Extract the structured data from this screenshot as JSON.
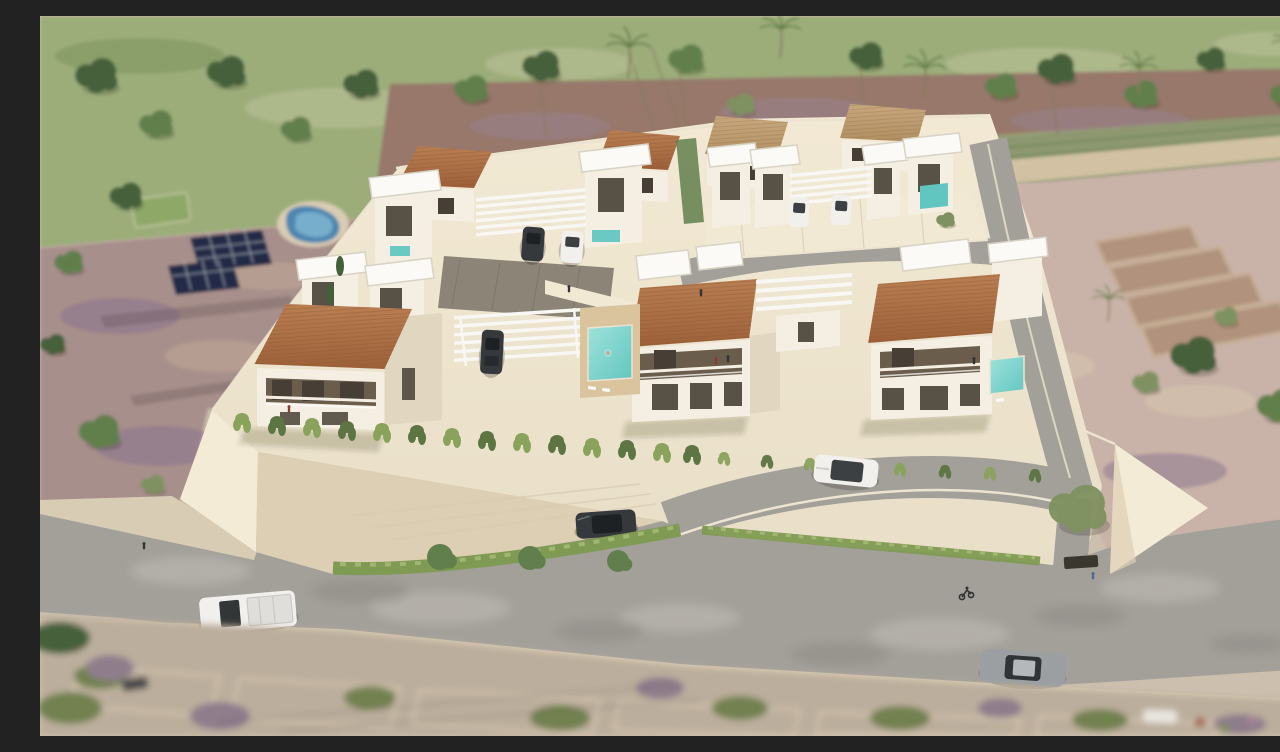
{
  "image": {
    "width": 1280,
    "height": 720,
    "alt": "Aerial 3D architectural rendering of a walled residential development: three terracotta-roofed white villas in front, rows of white cubic villas with flat slab roofs and pergola carports behind, a central turquoise pool with wooden deck, curved internal streets with parked and moving cars, a perimeter retaining wall draped with vines, a gray public road with a white pickup, gray sedan, cyclist and pedestrians, a neighboring plot with blue pool, solar panels and green court on the left, terraced pink farmland with stone walls on the right, a green tree-lined hillside above and a blurred old-town strip below."
  },
  "palette": {
    "grass_light": "#bcc199",
    "grass_mid": "#9cad7a",
    "grass_dark": "#7e9460",
    "scrub": "#8d986f",
    "tree_dark": "#44603a",
    "tree_mid": "#617f4c",
    "tree_olive": "#7f9160",
    "trunk": "#8a7a5e",
    "palm_frond": "#5f7c43",
    "mulch": "#97786a",
    "mulch_purple": "#9a8394",
    "path_sand": "#d2c1a3",
    "terrain_pink": "#c9b3a8",
    "terrain_sand": "#d9c8b0",
    "ruin_stone": "#c4aa8d",
    "ruin_fill": "#ab8b73",
    "plot_mauve": "#a78f8b",
    "plot_purple": "#8a7490",
    "plot_tan": "#c3a996",
    "court_green": "#8ea868",
    "pool_blue": "#4e86b0",
    "pool_blue_light": "#82b8d3",
    "solar_dark": "#232c47",
    "solar_grid": "#cdd3de",
    "platform": "#e9dfc8",
    "platform_light": "#f2e9d4",
    "paver_dark": "#8d8478",
    "wall_bright": "#f4ebd6",
    "wall_shade": "#ddcfb3",
    "house_white": "#f4efe2",
    "house_shade": "#e1d7c1",
    "window_dark": "#473f35",
    "recess": "#6b5d4c",
    "roof_terra": "#b97f52",
    "roof_terra_dark": "#9c6038",
    "roof_tan": "#c7a87e",
    "roof_tan_dark": "#b08f62",
    "tile_line": "#8c5633",
    "slab_white": "#fbfaf6",
    "slab_edge": "#d8d3c4",
    "pergola": "#f8f7f3",
    "road": "#a3a09a",
    "road_light": "#c7c3bb",
    "road_dark": "#8a8681",
    "curb": "#ece4d0",
    "sidewalk": "#d9ccb4",
    "hedge": "#7f9a52",
    "hedge_light": "#a9bd7a",
    "vine": "#8aa35c",
    "vine_dark": "#5c7542",
    "deck": "#d9c49e",
    "teal": "#62c6c0",
    "teal_light": "#9fe2db",
    "car_dark": "#35393c",
    "car_white": "#f1f0ec",
    "car_gray": "#9b9fa2",
    "glass": "#1d2124",
    "truck_bed": "#dfdedb",
    "person_dark": "#333333",
    "person_red": "#8a3b30",
    "person_blue": "#4a6b8a",
    "skin": "#caa184",
    "blur_base": "#bcae9c",
    "blur_green": "#72814f",
    "blur_purple": "#8f7d8c",
    "blur_wall": "#d8cab2",
    "grate": "#3a372f",
    "wire": "#2e2e2e"
  },
  "scene": {
    "setting": "gated villa development aerial view",
    "inventory": {
      "front_terracotta_villas": 3,
      "rear_terracotta_villas": 4,
      "white_roof_pavilions": 8,
      "pergola_carports": 4,
      "swimming_pools": 6,
      "solar_panel_arrays": 2,
      "sports_court": 1,
      "cars_parked": 5,
      "cars_on_road": 4,
      "cyclists": 1,
      "pedestrians": 5,
      "palm_trees": 6
    }
  }
}
